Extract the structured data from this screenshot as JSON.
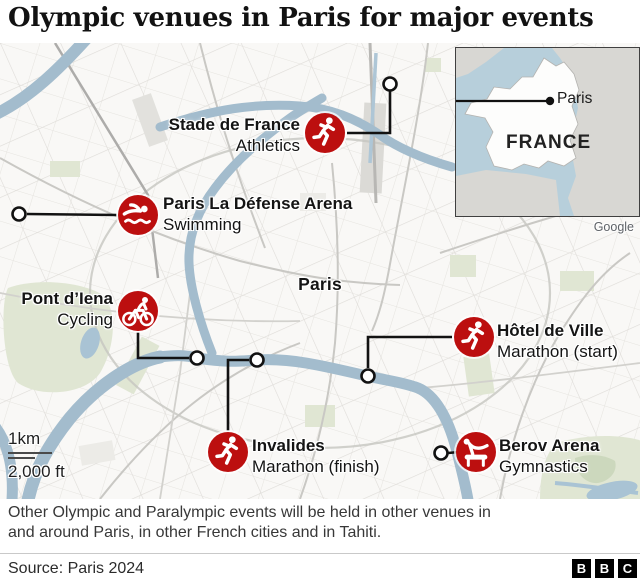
{
  "title": "Olympic venues in Paris for major events",
  "map": {
    "city_label": "Paris"
  },
  "venues": [
    {
      "name": "Stade de France",
      "sport": "Athletics",
      "icon": "runner-icon"
    },
    {
      "name": "Paris La Défense Arena",
      "sport": "Swimming",
      "icon": "swimmer-icon"
    },
    {
      "name": "Pont d’Iena",
      "sport": "Cycling",
      "icon": "cyclist-icon"
    },
    {
      "name": "Hôtel de Ville",
      "sport": "Marathon (start)",
      "icon": "runner-icon"
    },
    {
      "name": "Invalides",
      "sport": "Marathon (finish)",
      "icon": "runner-icon"
    },
    {
      "name": "Berov Arena",
      "sport": "Gymnastics",
      "icon": "gymnast-icon"
    }
  ],
  "inset": {
    "country_label": "FRANCE",
    "city_label": "Paris",
    "attribution": "Google"
  },
  "scale": {
    "metric": "1km",
    "imperial": "2,000 ft"
  },
  "caption": "Other Olympic and Paralympic events will be held in other venues in and around Paris, in other French cities and in Tahiti.",
  "footer": {
    "source": "Source: Paris 2024",
    "logo_letters": [
      "B",
      "B",
      "C"
    ]
  },
  "colors": {
    "venue_red": "#bc0f0f",
    "river_blue": "#a3bccd",
    "park_green": "#e0e6d3",
    "leader_line": "#121212"
  }
}
